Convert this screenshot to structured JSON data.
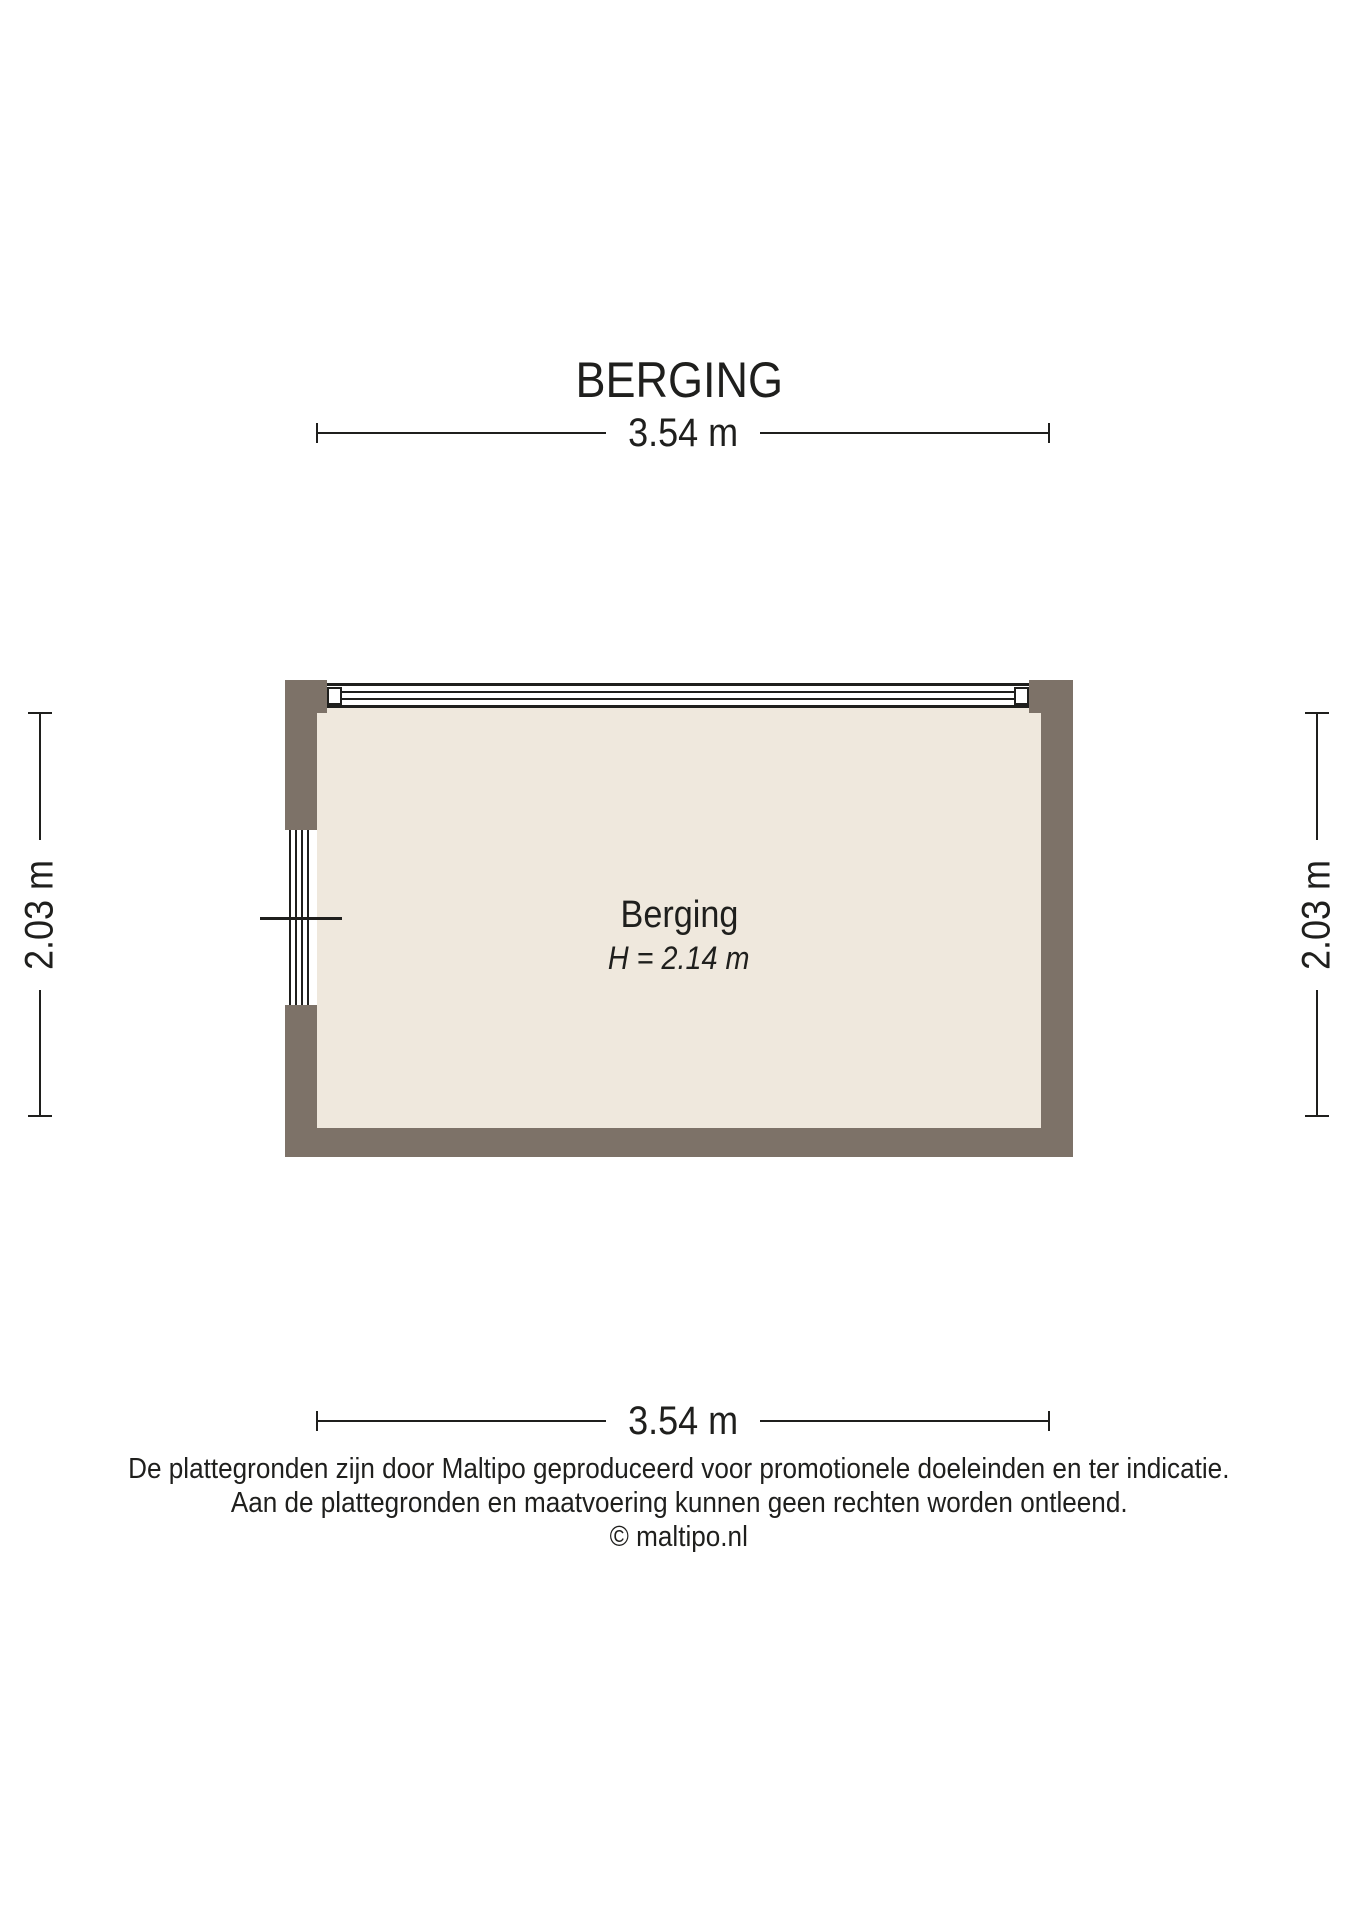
{
  "title": "BERGING",
  "colors": {
    "wall": "#7d7268",
    "floor": "#efe8dd",
    "line": "#1f1f1d"
  },
  "dimensions": {
    "width_top": "3.54 m",
    "width_bottom": "3.54 m",
    "height_left": "2.03 m",
    "height_right": "2.03 m"
  },
  "room": {
    "name": "Berging",
    "ceiling_height": "H = 2.14 m"
  },
  "footer": {
    "line1": "De plattegronden zijn door Maltipo geproduceerd voor promotionele doeleinden en ter indicatie.",
    "line2": "Aan de plattegronden en maatvoering kunnen geen rechten worden ontleend.",
    "line3": "© maltipo.nl"
  }
}
